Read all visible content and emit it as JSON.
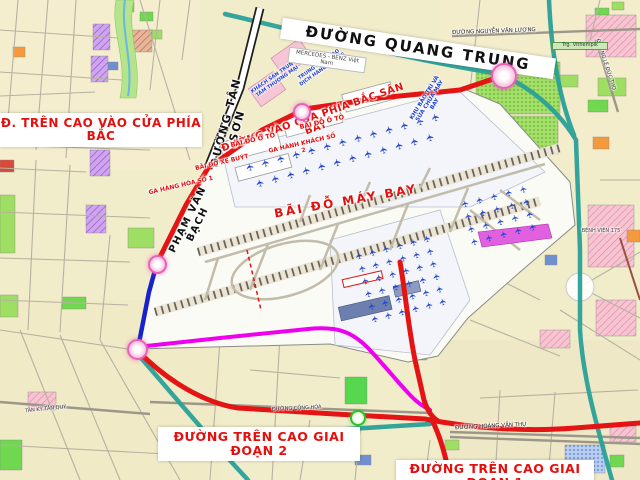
{
  "labels": {
    "quang_trung": "ĐƯỜNG QUANG TRUNG",
    "tren_cao_bac": "Đ. TRÊN CAO VÀO CỬA PHÍA BẮC",
    "tan_son": "ĐƯỜNG TÂN SƠN",
    "vao_cua_phia_bac": "ĐƯỜNG VÀO CỬA PHÍA BẮC SÂN BAY",
    "pham_van_bach": "PHẠM VĂN BẠCH",
    "bai_do_may_bay": "BÃI ĐỖ MÁY BAY",
    "bai_do_o_to_1": "BÃI ĐỖ Ô TÔ",
    "bai_do_o_to_2": "BÃI ĐỖ Ô TÔ",
    "bai_do_xe_buyt": "BÃI ĐỖ XE BUÝT",
    "ga_hang_hoa": "GA HÀNG HÓA SỐ 1",
    "ga_hanh_khach": "GA HÀNH KHÁCH SỐ 2",
    "khu_bao_tri": "KHU BẢO TRÌ VÀ SỬA CHỮA MÁY BAY",
    "khach_san": "KHÁCH SẠN TRUNG TÂM THƯƠNG MẠI",
    "tt_giao_dich": "TRUNG TÂM GIAO DỊCH HÀNG KHÔNG",
    "mercedes": "MERCEDES - BENZ Việt Nam",
    "giai_doan_2": "ĐƯỜNG TRÊN CAO GIAI ĐOẠN 2",
    "giai_doan_1": "ĐƯỜNG TRÊN CAO GIAI ĐOẠN 1",
    "hoang_van_thu": "ĐƯỜNG HOÀNG VĂN THỤ",
    "nguyen_van_luong": "ĐƯỜNG NGUYỄN VĂN LƯƠNG",
    "le_duc_tho": "ĐƯỜNG LÊ ĐỨC THỌ",
    "vithempik": "Trg. Vithempik",
    "tan_ky_tan_quy": "TÂN KỲ TÂN QUÝ",
    "cong_hoa": "ĐƯỜNG CỘNG HÒA",
    "benh_vien": "BỆNH VIỆN 175"
  },
  "icons": {
    "airplane": "✈"
  },
  "colors": {
    "map_background": "#f1ecca",
    "airport_fill": "#fbfbf6",
    "route_red": "#e51414",
    "route_magenta": "#ee00ee",
    "route_blue": "#1822cc",
    "road_teal": "#2aa198",
    "label_red": "#e3100e",
    "label_blue": "#1f3fd0",
    "node_pink": "#e863b8",
    "node_green": "#2ebf2e",
    "plane_blue": "#2244cc"
  },
  "plane_clusters": [
    {
      "x": 246,
      "y": 163,
      "cols": 13,
      "rows": 1,
      "dx": 16,
      "dy": 0,
      "rot": -15,
      "size": 10,
      "plane_rot": -90
    },
    {
      "x": 256,
      "y": 179,
      "cols": 12,
      "rows": 1,
      "dx": 16,
      "dy": 0,
      "rot": -15,
      "size": 10,
      "plane_rot": -90
    },
    {
      "x": 356,
      "y": 252,
      "cols": 6,
      "rows": 6,
      "dx": 14,
      "dy": 13,
      "rot": -14,
      "size": 9,
      "plane_rot": -90
    },
    {
      "x": 462,
      "y": 200,
      "cols": 5,
      "rows": 4,
      "dx": 15,
      "dy": 13,
      "rot": -14,
      "size": 9,
      "plane_rot": -90
    }
  ]
}
